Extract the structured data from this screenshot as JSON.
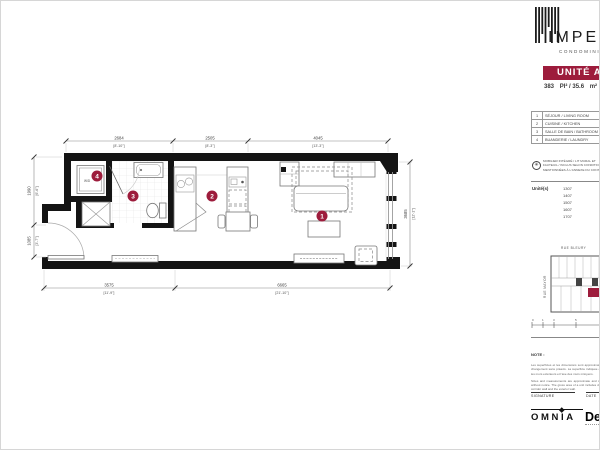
{
  "branding": {
    "logo_text": "IMPERIA",
    "logo_subtext": "CONDOMINIUMS",
    "accent_color": "#9D1C3C"
  },
  "header": {
    "unit_title": "UNITÉ A",
    "area_value_ft": "383",
    "area_mid": "PI² / 35.6",
    "area_unit": "m²"
  },
  "legend": {
    "rows": [
      {
        "num": "1",
        "label": "SÉJOUR / LIVING ROOM"
      },
      {
        "num": "2",
        "label": "CUISINE / KITCHEN"
      },
      {
        "num": "3",
        "label": "SALLE DE BAIN / BATHROOM"
      },
      {
        "num": "4",
        "label": "BUANDERIE / LAUNDRY"
      }
    ]
  },
  "furniture_note": {
    "icon": "asterisk-circle-icon",
    "lines": [
      "MOBILIER INTÉGRÉ / LIT MURAL ET",
      "FAUTEUIL / INCLUS SELON CONDITIONS",
      "MENTIONNÉES À L'ANNEXE DU CONTRAT"
    ]
  },
  "units": {
    "label": "Unité(s)",
    "numbers": [
      "1307",
      "1407",
      "1507",
      "1607",
      "1707"
    ]
  },
  "keyplan": {
    "street_top": "RUE BLEURY",
    "street_left": "RUE MAYOR",
    "scale_ticks": [
      "0",
      "1",
      "3",
      "5"
    ]
  },
  "notes": {
    "title": "NOTE :",
    "paragraph_fr": "Les superficies et les dimensions sont approximatives et sujettes à changement sans préavis. La superficie indiquée est calculée selon les murs extérieurs et l'axe des murs mitoyens.",
    "paragraph_en": "Sizes and measurements are approximate and subject to change without notice. The gross area of a unit includes demising walls, the corridor wall and the exterior wall."
  },
  "signature": {
    "signature_label": "SIGNATURE",
    "date_label": "DATE"
  },
  "footer": {
    "brand_primary": "OMNIA",
    "brand_secondary": "De"
  },
  "plan": {
    "markers": [
      {
        "num": "1"
      },
      {
        "num": "2"
      },
      {
        "num": "3"
      },
      {
        "num": "4"
      }
    ],
    "washer_label": "W/D",
    "dims": {
      "top": [
        {
          "mm": "2684",
          "ft": "[8'-10\"]"
        },
        {
          "mm": "2505",
          "ft": "[8'-3\"]"
        },
        {
          "mm": "4045",
          "ft": "[13'-3\"]"
        }
      ],
      "bottom": [
        {
          "mm": "3575",
          "ft": "[11'-9\"]"
        },
        {
          "mm": "6665",
          "ft": "[21'-10\"]"
        }
      ],
      "left": [
        {
          "mm": "1990",
          "ft": "[6'-6\"]"
        },
        {
          "mm": "1085",
          "ft": "[3'-7\"]"
        }
      ],
      "right": [
        {
          "mm": "3685",
          "ft": "[12'-1\"]"
        }
      ]
    }
  }
}
